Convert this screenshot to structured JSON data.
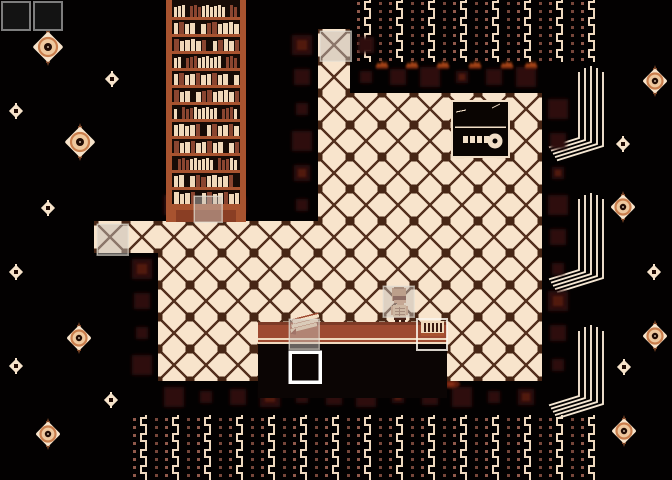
{
  "window": {
    "kind": "game-screen",
    "width": 672,
    "height": 480
  },
  "scene": {
    "background": "#030101",
    "colors": {
      "floor_base": "#F8E4CC",
      "floor_line": "#55311F",
      "floor_node": "#47261576",
      "node": "#472615",
      "ember": "#2E0F08",
      "ember_bright": "#591C0E",
      "flame_top": "#A84419",
      "flame_top_base": "#5E1E0F",
      "flame_bottom": "#5E1F10",
      "flame_bottom_core": "#8A2E16",
      "pattern_zig": "#EFD9BF",
      "pattern_dot_a": "#76463A",
      "pattern_dot_b": "#90594B",
      "shelf_frame": "#A8532F",
      "shelf_dark": "#170B06",
      "shelf_base_inner": "#8A3E24",
      "book_cream": "#F0D8BA",
      "book_brown": "#8A4530",
      "beam": "#F5E6D2",
      "eye_cream": "#F7E3CA",
      "eye_mid": "#C97E4D",
      "eye_fill": "#EFC89E",
      "eye_dark": "#200B04",
      "eye_stem": "#7C4526",
      "desk_top": "#9E4A31",
      "desk_top_dark": "#7C3A26",
      "desk_line": "#EFD9BE",
      "desk_front": "#0B0504",
      "safe_line": "#F2DFC7",
      "safe_fill": "#0A0502",
      "overlay_gray": "rgba(195,190,183,0.5)",
      "overlay_gray_border": "rgba(228,222,212,0.65)",
      "box_white": "#FFFFFF",
      "box_white_thin": "rgba(250,245,235,0.85)",
      "slot_fill": "#131313",
      "slot_border": "#7D7D7D",
      "char_skin": "#C4906E",
      "char_skin_light": "#D8B28E",
      "char_head": "#B5805F",
      "char_head_top": "#8E5F43",
      "char_face_low": "#C79170",
      "char_band": "#5A1F12",
      "char_rib": "#8A5B42",
      "char_waist": "#4A2217",
      "char_feet": "#3A1A10"
    },
    "ui_slots": [
      {
        "x": 2,
        "y": 2,
        "w": 28,
        "h": 28
      },
      {
        "x": 34,
        "y": 2,
        "w": 28,
        "h": 28
      }
    ],
    "floor": {
      "tile": 32,
      "origin": [
        30,
        29
      ],
      "rects": [
        [
          318,
          29,
          32,
          32
        ],
        [
          318,
          61,
          32,
          32
        ],
        [
          318,
          93,
          224,
          128
        ],
        [
          94,
          221,
          448,
          32
        ],
        [
          158,
          253,
          384,
          128
        ]
      ]
    },
    "pattern_areas": [
      {
        "x": 356,
        "y": 0,
        "w": 246,
        "h": 62
      },
      {
        "x": 133,
        "y": 415,
        "w": 469,
        "h": 65
      }
    ],
    "bookshelf": {
      "x": 166,
      "y": 0,
      "w": 80,
      "h": 222,
      "rows": 12
    },
    "safe": {
      "x": 452,
      "y": 101,
      "w": 57,
      "h": 56
    },
    "desk": {
      "x": 258,
      "y": 322,
      "w": 189,
      "surface_h": 21,
      "front_bottom": 398
    },
    "desk_items": {
      "papers": {
        "x": 288,
        "y": 320
      },
      "rack": {
        "x": 421,
        "y": 321,
        "w": 23,
        "h": 15
      }
    },
    "character": {
      "x": 391,
      "y": 287
    },
    "highlights": [
      {
        "type": "gray",
        "x": 320,
        "y": 31,
        "w": 31,
        "h": 30,
        "name": "highlight-top-tile"
      },
      {
        "type": "gray",
        "x": 97,
        "y": 224,
        "w": 31,
        "h": 31,
        "name": "highlight-left-tile"
      },
      {
        "type": "gray",
        "x": 194,
        "y": 196,
        "w": 28,
        "h": 26,
        "name": "highlight-bookshelf"
      },
      {
        "type": "gray",
        "x": 383,
        "y": 286,
        "w": 31,
        "h": 31,
        "name": "highlight-character-tile"
      },
      {
        "type": "gray",
        "x": 289,
        "y": 319,
        "w": 30,
        "h": 30,
        "name": "highlight-desk-papers"
      },
      {
        "type": "white",
        "x": 290,
        "y": 352,
        "w": 30,
        "h": 30,
        "name": "cursor-below-desk"
      },
      {
        "type": "white-thin",
        "x": 417,
        "y": 319,
        "w": 30,
        "h": 31,
        "name": "cursor-desk-rack"
      }
    ],
    "eyes": [
      {
        "x": 48,
        "y": 47,
        "size": "L"
      },
      {
        "x": 112,
        "y": 79,
        "size": "S"
      },
      {
        "x": 16,
        "y": 111,
        "size": "S"
      },
      {
        "x": 80,
        "y": 142,
        "size": "L"
      },
      {
        "x": 48,
        "y": 208,
        "size": "S"
      },
      {
        "x": 16,
        "y": 272,
        "size": "S"
      },
      {
        "x": 79,
        "y": 338,
        "size": "M"
      },
      {
        "x": 16,
        "y": 366,
        "size": "S"
      },
      {
        "x": 111,
        "y": 400,
        "size": "S"
      },
      {
        "x": 48,
        "y": 434,
        "size": "M"
      },
      {
        "x": 655,
        "y": 81,
        "size": "M"
      },
      {
        "x": 623,
        "y": 144,
        "size": "S"
      },
      {
        "x": 623,
        "y": 207,
        "size": "M"
      },
      {
        "x": 654,
        "y": 272,
        "size": "S"
      },
      {
        "x": 655,
        "y": 336,
        "size": "M"
      },
      {
        "x": 624,
        "y": 367,
        "size": "S"
      },
      {
        "x": 624,
        "y": 431,
        "size": "M"
      }
    ],
    "beams": [
      {
        "x": 579,
        "top": 66,
        "bottom": 146
      },
      {
        "x": 579,
        "top": 193,
        "bottom": 278
      },
      {
        "x": 579,
        "top": 325,
        "bottom": 404
      }
    ],
    "flames": {
      "top": {
        "y": 63,
        "xs": [
          382,
          412,
          443,
          475,
          507,
          531
        ]
      },
      "bottom": {
        "y": 384,
        "xs": [
          289,
          337,
          385,
          417,
          451
        ]
      }
    }
  }
}
